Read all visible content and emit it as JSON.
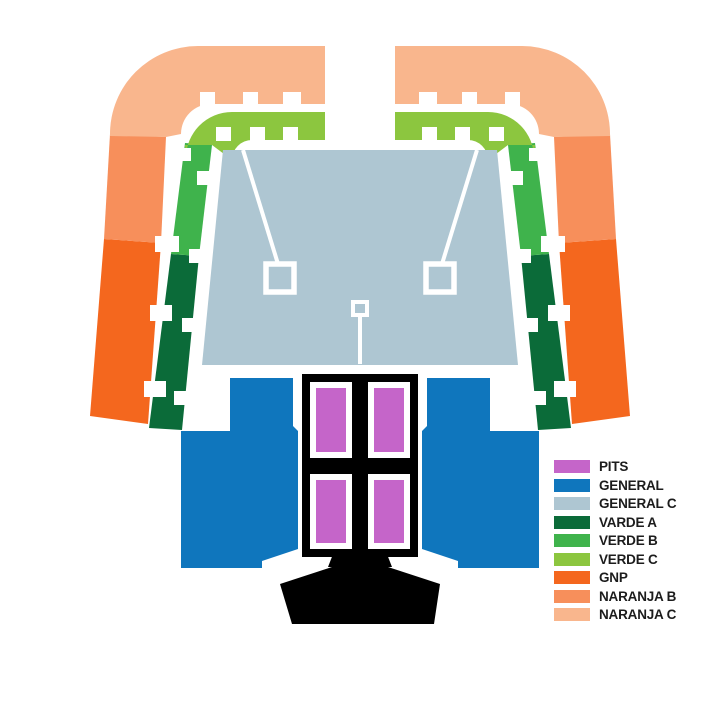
{
  "sections": {
    "pits": {
      "label": "PITS",
      "color": "#C565C9"
    },
    "general": {
      "label": "GENERAL",
      "color": "#0F76BD"
    },
    "general_c": {
      "label": "GENERAL C",
      "color": "#AEC6D2"
    },
    "varde_a": {
      "label": "VARDE A",
      "color": "#0B6B39"
    },
    "verde_b": {
      "label": "VERDE B",
      "color": "#3FB34C"
    },
    "verde_c": {
      "label": "VERDE C",
      "color": "#8CC63F"
    },
    "gnp": {
      "label": "GNP",
      "color": "#F4671E"
    },
    "naranja_b": {
      "label": "NARANJA B",
      "color": "#F78F5B"
    },
    "naranja_c": {
      "label": "NARANJA C",
      "color": "#F9B68D"
    }
  },
  "stage": {
    "color": "#000000"
  },
  "markers": {
    "outline_color": "#FFFFFF"
  }
}
